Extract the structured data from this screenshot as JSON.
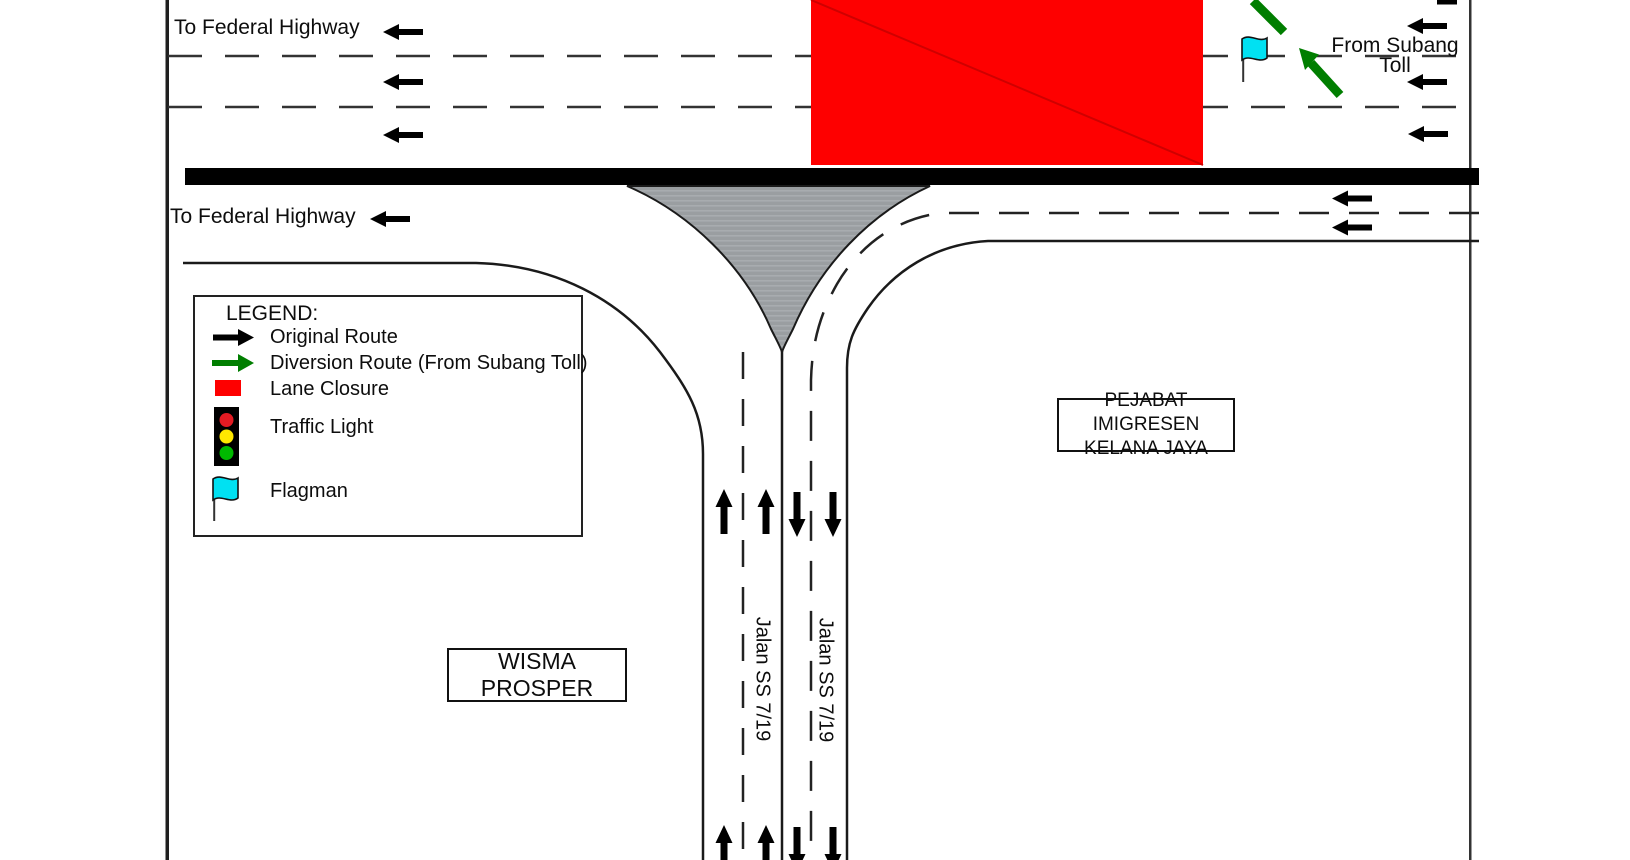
{
  "labels": {
    "to_federal_highway_top": "To Federal Highway",
    "to_federal_highway_bottom": "To Federal Highway",
    "from_subang_line1": "From Subang",
    "from_subang_line2": "Toll"
  },
  "roads": {
    "south_road_label_left": "Jalan SS 7/19",
    "south_road_label_right": "Jalan SS 7/19"
  },
  "buildings": {
    "immigration": {
      "line1": "PEJABAT IMIGRESEN",
      "line2": "KELANA JAYA"
    },
    "wisma": "WISMA PROSPER"
  },
  "legend": {
    "title": "LEGEND:",
    "items": [
      {
        "icon": "black-arrow-right-icon",
        "label": "Original Route"
      },
      {
        "icon": "green-arrow-right-icon",
        "label": "Diversion Route (From Subang Toll)"
      },
      {
        "icon": "lane-closure-swatch-icon",
        "label": "Lane Closure"
      },
      {
        "icon": "traffic-light-icon",
        "label": "Traffic Light"
      },
      {
        "icon": "flagman-flag-icon",
        "label": "Flagman"
      }
    ]
  },
  "colors": {
    "lane_closure_red": "#FE0000",
    "diversion_green": "#007E00",
    "flag_cyan": "#00E1F2",
    "island_gray": "#9A9EA1",
    "road_line": "#1A1A1A",
    "traffic_light_red": "#E31B23",
    "traffic_light_yellow": "#FFE800",
    "traffic_light_green": "#00B900"
  }
}
